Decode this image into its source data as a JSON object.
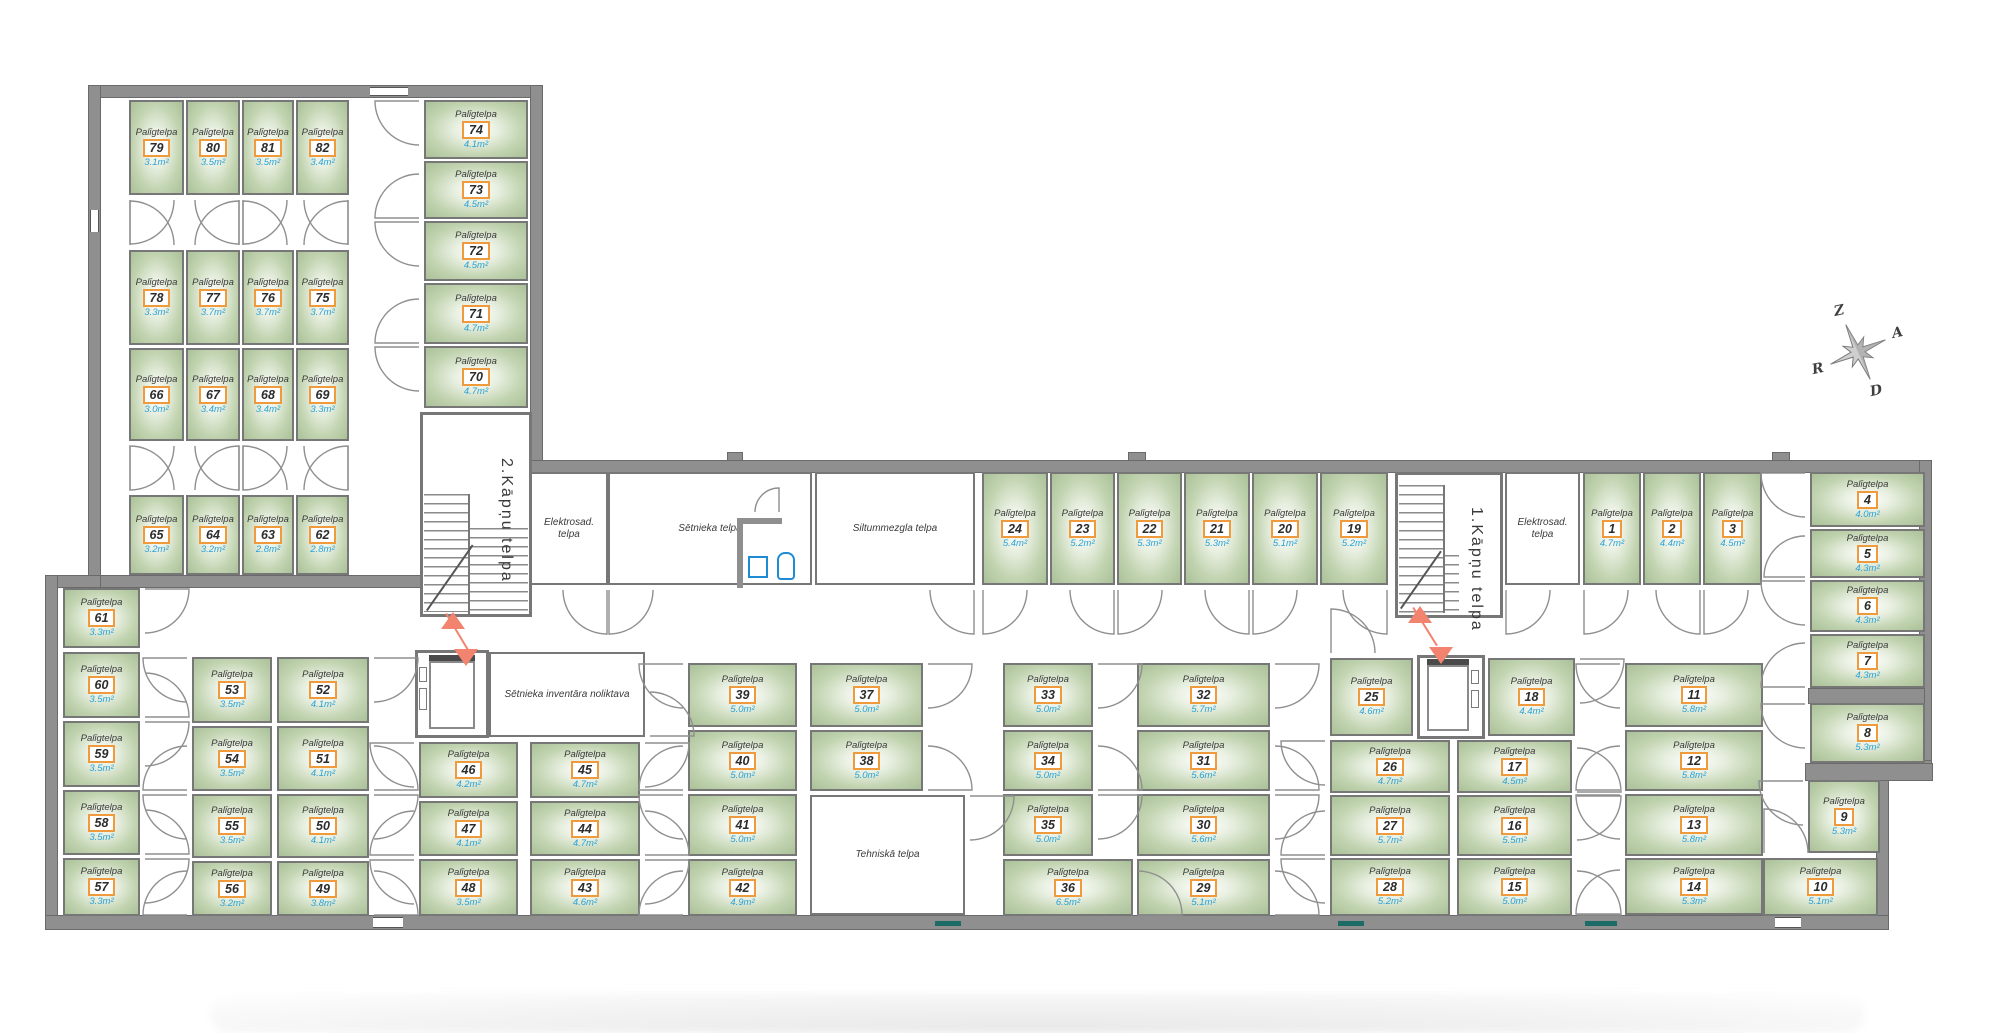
{
  "labels": {
    "storage_room": "Palīgtelpa"
  },
  "colors": {
    "wall": "#8f8f8f",
    "room_border": "#777777",
    "room_fill_edge": "#a6be94",
    "room_fill_center": "#ffffff",
    "number_box_border": "#ef9a3d",
    "area_text": "#2aa2d8",
    "entry_arrow": "#f2836f",
    "window_teal": "#1d6b66",
    "wc_fixture": "#1f8bd4"
  },
  "compass": {
    "north": "Z",
    "east": "A",
    "south": "D",
    "west": "R"
  },
  "stairwells": [
    {
      "label": "2.Kāpņu telpa"
    },
    {
      "label": "1.Kāpņu telpa"
    }
  ],
  "rooms": [
    [
      "79",
      "3.1m²",
      129,
      100,
      55,
      95,
      "B0"
    ],
    [
      "80",
      "3.5m²",
      186,
      100,
      54,
      95,
      "B1"
    ],
    [
      "81",
      "3.5m²",
      242,
      100,
      52,
      95,
      "B0"
    ],
    [
      "82",
      "3.4m²",
      296,
      100,
      53,
      95,
      "B1"
    ],
    [
      "78",
      "3.3m²",
      129,
      250,
      55,
      95,
      "T0"
    ],
    [
      "77",
      "3.7m²",
      186,
      250,
      54,
      95,
      "T1"
    ],
    [
      "76",
      "3.7m²",
      242,
      250,
      52,
      95,
      "T0"
    ],
    [
      "75",
      "3.7m²",
      296,
      250,
      53,
      95,
      "T1"
    ],
    [
      "66",
      "3.0m²",
      129,
      348,
      55,
      93,
      "B0"
    ],
    [
      "67",
      "3.4m²",
      186,
      348,
      54,
      93,
      "B1"
    ],
    [
      "68",
      "3.4m²",
      242,
      348,
      52,
      93,
      "B0"
    ],
    [
      "69",
      "3.3m²",
      296,
      348,
      53,
      93,
      "B1"
    ],
    [
      "65",
      "3.2m²",
      129,
      495,
      55,
      80,
      "T0"
    ],
    [
      "64",
      "3.2m²",
      186,
      495,
      54,
      80,
      "T1"
    ],
    [
      "63",
      "2.8m²",
      242,
      495,
      52,
      80,
      "T0"
    ],
    [
      "62",
      "2.8m²",
      296,
      495,
      53,
      80,
      "T1"
    ],
    [
      "74",
      "4.1m²",
      424,
      100,
      104,
      59,
      "L0"
    ],
    [
      "73",
      "4.5m²",
      424,
      161,
      104,
      58,
      "L1"
    ],
    [
      "72",
      "4.5m²",
      424,
      221,
      104,
      60,
      "L0"
    ],
    [
      "71",
      "4.7m²",
      424,
      283,
      104,
      61,
      "L1"
    ],
    [
      "70",
      "4.7m²",
      424,
      346,
      104,
      62,
      "L0"
    ],
    [
      "24",
      "5.4m²",
      982,
      472,
      66,
      113,
      "B0"
    ],
    [
      "23",
      "5.2m²",
      1050,
      472,
      65,
      113,
      "B1"
    ],
    [
      "22",
      "5.3m²",
      1117,
      472,
      65,
      113,
      "B0"
    ],
    [
      "21",
      "5.3m²",
      1184,
      472,
      66,
      113,
      "B1"
    ],
    [
      "20",
      "5.1m²",
      1252,
      472,
      66,
      113,
      "B0"
    ],
    [
      "19",
      "5.2m²",
      1320,
      472,
      68,
      113,
      "B1"
    ],
    [
      "1",
      "4.7m²",
      1583,
      472,
      58,
      113,
      "B0"
    ],
    [
      "2",
      "4.4m²",
      1643,
      472,
      58,
      113,
      "B1"
    ],
    [
      "3",
      "4.5m²",
      1703,
      472,
      59,
      113,
      "B0"
    ],
    [
      "4",
      "4.0m²",
      1810,
      472,
      115,
      55,
      "L0"
    ],
    [
      "5",
      "4.3m²",
      1810,
      529,
      115,
      49,
      "L1"
    ],
    [
      "6",
      "4.3m²",
      1810,
      580,
      115,
      52,
      "L0"
    ],
    [
      "7",
      "4.3m²",
      1810,
      634,
      115,
      54,
      "L1"
    ],
    [
      "8",
      "5.3m²",
      1810,
      703,
      115,
      60,
      "L0"
    ],
    [
      "9",
      "5.3m²",
      1808,
      780,
      72,
      73,
      "L0"
    ],
    [
      "10",
      "5.1m²",
      1763,
      858,
      115,
      58,
      "T0"
    ],
    [
      "61",
      "3.3m²",
      63,
      588,
      77,
      60,
      "R0"
    ],
    [
      "60",
      "3.5m²",
      63,
      652,
      77,
      66,
      "R1"
    ],
    [
      "59",
      "3.5m²",
      63,
      721,
      77,
      66,
      "R0"
    ],
    [
      "58",
      "3.5m²",
      63,
      790,
      77,
      65,
      "R1"
    ],
    [
      "57",
      "3.3m²",
      63,
      858,
      77,
      58,
      "R0"
    ],
    [
      "53",
      "3.5m²",
      192,
      657,
      80,
      66,
      "L0"
    ],
    [
      "54",
      "3.5m²",
      192,
      726,
      80,
      65,
      "L1"
    ],
    [
      "55",
      "3.5m²",
      192,
      794,
      80,
      64,
      "L0"
    ],
    [
      "56",
      "3.2m²",
      192,
      861,
      80,
      55,
      "L1"
    ],
    [
      "52",
      "4.1m²",
      277,
      657,
      92,
      66,
      "R0"
    ],
    [
      "51",
      "4.1m²",
      277,
      726,
      92,
      65,
      "R1"
    ],
    [
      "50",
      "4.1m²",
      277,
      794,
      92,
      64,
      "R0"
    ],
    [
      "49",
      "3.8m²",
      277,
      861,
      92,
      55,
      "R1"
    ],
    [
      "46",
      "4.2m²",
      419,
      742,
      99,
      56,
      "L0"
    ],
    [
      "47",
      "4.1m²",
      419,
      801,
      99,
      55,
      "L1"
    ],
    [
      "48",
      "3.5m²",
      419,
      859,
      99,
      57,
      "L0"
    ],
    [
      "45",
      "4.7m²",
      530,
      742,
      110,
      56,
      "R0"
    ],
    [
      "44",
      "4.7m²",
      530,
      801,
      110,
      55,
      "R1"
    ],
    [
      "43",
      "4.6m²",
      530,
      859,
      110,
      57,
      "R0"
    ],
    [
      "39",
      "5.0m²",
      688,
      663,
      109,
      64,
      "L0"
    ],
    [
      "40",
      "5.0m²",
      688,
      730,
      109,
      61,
      "L1"
    ],
    [
      "41",
      "5.0m²",
      688,
      794,
      109,
      62,
      "L0"
    ],
    [
      "42",
      "4.9m²",
      688,
      859,
      109,
      57,
      "L1"
    ],
    [
      "37",
      "5.0m²",
      810,
      663,
      113,
      64,
      "R0"
    ],
    [
      "38",
      "5.0m²",
      810,
      730,
      113,
      61,
      "R1"
    ],
    [
      "33",
      "5.0m²",
      1003,
      663,
      90,
      64,
      "R0"
    ],
    [
      "34",
      "5.0m²",
      1003,
      730,
      90,
      61,
      "R1"
    ],
    [
      "35",
      "5.0m²",
      1003,
      794,
      90,
      62,
      "R0"
    ],
    [
      "36",
      "6.5m²",
      1003,
      859,
      130,
      57,
      "R1"
    ],
    [
      "32",
      "5.7m²",
      1137,
      663,
      133,
      64,
      "R0"
    ],
    [
      "31",
      "5.6m²",
      1137,
      730,
      133,
      61,
      "R1"
    ],
    [
      "30",
      "5.6m²",
      1137,
      794,
      133,
      62,
      "R0"
    ],
    [
      "29",
      "5.1m²",
      1137,
      859,
      133,
      57,
      "R1"
    ],
    [
      "25",
      "4.6m²",
      1330,
      658,
      83,
      78,
      "T0"
    ],
    [
      "26",
      "4.7m²",
      1330,
      740,
      120,
      53,
      "L0"
    ],
    [
      "27",
      "5.7m²",
      1330,
      795,
      120,
      61,
      "L1"
    ],
    [
      "28",
      "5.2m²",
      1330,
      858,
      120,
      58,
      "L0"
    ],
    [
      "18",
      "4.4m²",
      1488,
      658,
      87,
      78,
      "R0"
    ],
    [
      "17",
      "4.5m²",
      1457,
      740,
      115,
      53,
      "R1"
    ],
    [
      "16",
      "5.5m²",
      1457,
      795,
      115,
      61,
      "R0"
    ],
    [
      "15",
      "5.0m²",
      1457,
      858,
      115,
      58,
      "R1"
    ],
    [
      "11",
      "5.8m²",
      1625,
      663,
      138,
      64,
      "L0"
    ],
    [
      "12",
      "5.8m²",
      1625,
      730,
      138,
      61,
      "L1"
    ],
    [
      "13",
      "5.8m²",
      1625,
      794,
      138,
      62,
      "L0"
    ],
    [
      "14",
      "5.3m²",
      1625,
      858,
      138,
      57,
      "L1"
    ]
  ],
  "white_rooms": [
    [
      "Elektrosad.\ntelpa",
      530,
      472,
      78,
      113,
      "B1"
    ],
    [
      "Sētnieka telpa",
      608,
      472,
      204,
      113,
      "B0"
    ],
    [
      "Siltummezgla telpa",
      815,
      472,
      160,
      113,
      "B1"
    ],
    [
      "Sētnieka inventāra noliktava",
      489,
      652,
      156,
      85,
      "R1"
    ],
    [
      "Tehniskā telpa",
      810,
      795,
      155,
      120,
      "R0"
    ],
    [
      "Elektrosad.\ntelpa",
      1505,
      472,
      75,
      113,
      "B0"
    ]
  ],
  "walls": [
    [
      88,
      85,
      455,
      13
    ],
    [
      88,
      85,
      13,
      503
    ],
    [
      530,
      85,
      13,
      390
    ],
    [
      88,
      575,
      347,
      13
    ],
    [
      45,
      575,
      56,
      13
    ],
    [
      45,
      575,
      13,
      353
    ],
    [
      530,
      460,
      1402,
      13
    ],
    [
      1919,
      460,
      13,
      312
    ],
    [
      1876,
      760,
      56,
      13
    ],
    [
      1876,
      760,
      13,
      168
    ],
    [
      45,
      915,
      1844,
      15
    ],
    [
      1808,
      688,
      117,
      16
    ],
    [
      1805,
      763,
      128,
      18
    ]
  ],
  "bumps": [
    [
      1128,
      452,
      18,
      9
    ],
    [
      727,
      452,
      16,
      9
    ],
    [
      1772,
      452,
      18,
      9
    ]
  ],
  "windows_h": [
    [
      370,
      87,
      38,
      9
    ],
    [
      373,
      917,
      30,
      11
    ],
    [
      1775,
      917,
      26,
      11
    ]
  ],
  "windows_v": [
    [
      90,
      210,
      9,
      22
    ]
  ],
  "windows_teal": [
    [
      935,
      921,
      26,
      5
    ],
    [
      1338,
      921,
      26,
      5
    ],
    [
      1585,
      921,
      32,
      5
    ]
  ],
  "stair_geo": {
    "room2": [
      420,
      412,
      112,
      205
    ],
    "flights2": [
      [
        424,
        494,
        46,
        118
      ],
      [
        470,
        528,
        58,
        86
      ]
    ],
    "vline2": [
      468,
      494,
      2,
      120
    ],
    "diag2": [
      426,
      610,
      80,
      -55
    ],
    "label2": [
      486,
      425,
      40,
      190
    ],
    "room1": [
      1395,
      472,
      108,
      146
    ],
    "flights1": [
      [
        1399,
        485,
        44,
        128
      ],
      [
        1445,
        555,
        14,
        58
      ]
    ],
    "vline1": [
      1443,
      485,
      2,
      128
    ],
    "diag1": [
      1400,
      608,
      70,
      -55
    ],
    "label1": [
      1456,
      482,
      40,
      175
    ]
  },
  "lifts": [
    {
      "shaft": [
        415,
        650,
        74,
        88
      ],
      "car": [
        429,
        661,
        46,
        68
      ],
      "band": [
        429,
        655,
        46,
        7
      ],
      "fix": [
        [
          419,
          667,
          8,
          15
        ],
        [
          419,
          688,
          8,
          22
        ]
      ]
    },
    {
      "shaft": [
        1417,
        655,
        68,
        84
      ],
      "car": [
        1427,
        665,
        42,
        66
      ],
      "band": [
        1427,
        659,
        42,
        7
      ],
      "fix": [
        [
          1471,
          670,
          8,
          14
        ],
        [
          1471,
          690,
          8,
          18
        ]
      ]
    }
  ],
  "wc": {
    "walls": [
      [
        737,
        518,
        6,
        70
      ],
      [
        737,
        518,
        45,
        6
      ]
    ],
    "sink": [
      748,
      556,
      20,
      22
    ],
    "toilet": [
      777,
      552,
      18,
      28
    ]
  },
  "doors_extra": [
    [
      779,
      512,
      24,
      270,
      180
    ]
  ],
  "arrows": [
    {
      "up": [
        441,
        612
      ],
      "down": [
        454,
        632
      ],
      "line": [
        447,
        613,
        45,
        59
      ]
    },
    {
      "up": [
        1408,
        606
      ],
      "down": [
        1429,
        630
      ],
      "line": [
        1414,
        607,
        45,
        58
      ]
    }
  ],
  "compass_geo": {
    "cx": 1858,
    "cy": 352,
    "rot": -24,
    "r_long": 30,
    "r_short": 16,
    "r_in": 7,
    "letter_r": 44
  }
}
